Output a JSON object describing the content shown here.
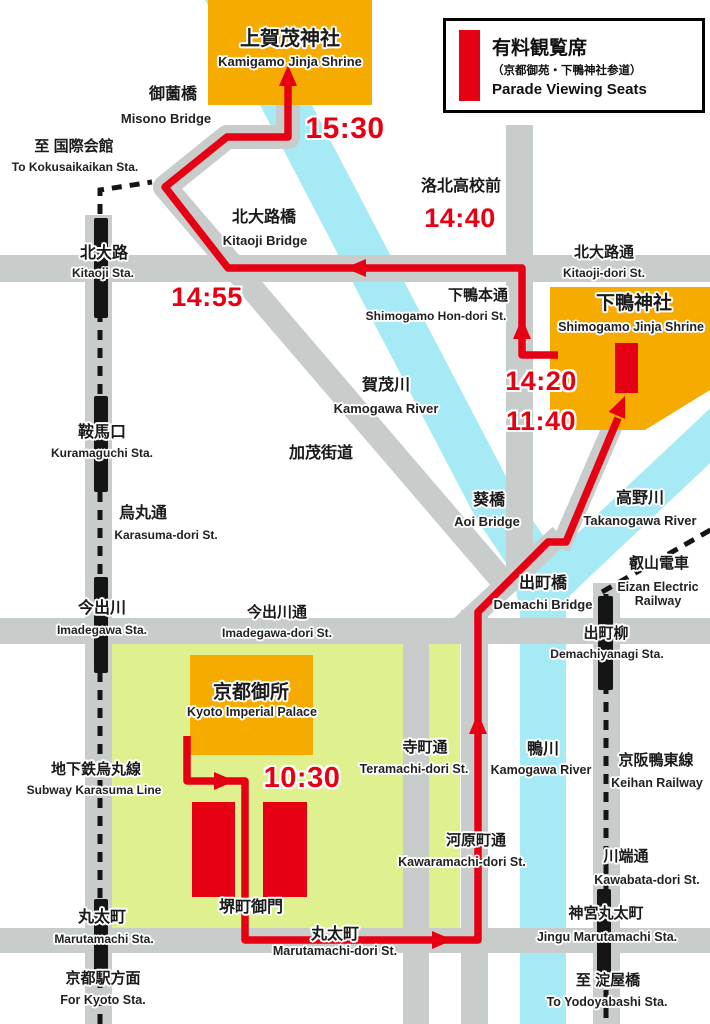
{
  "legend": {
    "title_jp": "有料観覧席",
    "note_jp": "（京都御苑・下鴨神社参道）",
    "title_en": "Parade Viewing Seats"
  },
  "times": {
    "depart_palace": "10:30",
    "arrive_shimogamo": "11:40",
    "depart_shimogamo": "14:20",
    "rakuhoku_pass": "14:40",
    "kitaoji_pass": "14:55",
    "arrive_kamigamo": "15:30"
  },
  "places": {
    "kamigamo": {
      "jp": "上賀茂神社",
      "en": "Kamigamo Jinja Shrine"
    },
    "shimogamo": {
      "jp": "下鴨神社",
      "en": "Shimogamo Jinja Shrine"
    },
    "palace": {
      "jp": "京都御所",
      "en": "Kyoto Imperial Palace"
    },
    "sakaimachi_gomon": {
      "jp": "堺町御門"
    },
    "rakuhoku": {
      "jp": "洛北高校前"
    },
    "kamo_kaido": {
      "jp": "加茂街道"
    }
  },
  "bridges": {
    "misono": {
      "jp": "御薗橋",
      "en": "Misono Bridge"
    },
    "kitaoji": {
      "jp": "北大路橋",
      "en": "Kitaoji Bridge"
    },
    "aoi": {
      "jp": "葵橋",
      "en": "Aoi Bridge"
    },
    "demachi": {
      "jp": "出町橋",
      "en": "Demachi Bridge"
    }
  },
  "rivers": {
    "kamogawa_upper": {
      "jp": "賀茂川",
      "en": "Kamogawa River"
    },
    "takanogawa": {
      "jp": "高野川",
      "en": "Takanogawa River"
    },
    "kamogawa_lower": {
      "jp": "鴨川",
      "en": "Kamogawa River"
    }
  },
  "streets": {
    "kitaoji_dori": {
      "jp": "北大路通",
      "en": "Kitaoji-dori St."
    },
    "karasuma": {
      "jp": "烏丸通",
      "en": "Karasuma-dori St."
    },
    "imadegawa": {
      "jp": "今出川通",
      "en": "Imadegawa-dori St."
    },
    "shimogamo_hondori": {
      "jp": "下鴨本通",
      "en": "Shimogamo Hon-dori St."
    },
    "teramachi": {
      "jp": "寺町通",
      "en": "Teramachi-dori St."
    },
    "kawaramachi": {
      "jp": "河原町通",
      "en": "Kawaramachi-dori St."
    },
    "marutamachi": {
      "jp": "丸太町",
      "en": "Marutamachi-dori St."
    },
    "kawabata": {
      "jp": "川端通",
      "en": "Kawabata-dori St."
    }
  },
  "stations": {
    "kitaoji": {
      "jp": "北大路",
      "en": "Kitaoji Sta."
    },
    "kuramaguchi": {
      "jp": "鞍馬口",
      "en": "Kuramaguchi Sta."
    },
    "imadegawa": {
      "jp": "今出川",
      "en": "Imadegawa Sta."
    },
    "marutamachi": {
      "jp": "丸太町",
      "en": "Marutamachi Sta."
    },
    "demachiyanagi": {
      "jp": "出町柳",
      "en": "Demachiyanagi Sta."
    },
    "jingu_marutamachi": {
      "jp": "神宮丸太町",
      "en": "Jingu Marutamachi Sta."
    }
  },
  "railways": {
    "subway_karasuma": {
      "jp": "地下鉄烏丸線",
      "en": "Subway Karasuma Line"
    },
    "eizan": {
      "jp": "叡山電車",
      "en": "Eizan Electric Railway"
    },
    "keihan": {
      "jp": "京阪鴨東線",
      "en": "Keihan Railway"
    }
  },
  "directions": {
    "kokusaikaikan": {
      "jp": "至 国際会館",
      "en": "To Kokusaikaikan Sta."
    },
    "kyoto": {
      "jp": "京都駅方面",
      "en": "For Kyoto Sta."
    },
    "yodoyabashi": {
      "jp": "至 淀屋橋",
      "en": "To Yodoyabashi Sta."
    }
  },
  "colors": {
    "route_red": "#e60013",
    "shrine_orange": "#f6ab00",
    "river_cyan": "#a5eaf4",
    "road_gray": "#c8cccb",
    "park_green": "#dff18f",
    "rail_black": "#151515"
  }
}
